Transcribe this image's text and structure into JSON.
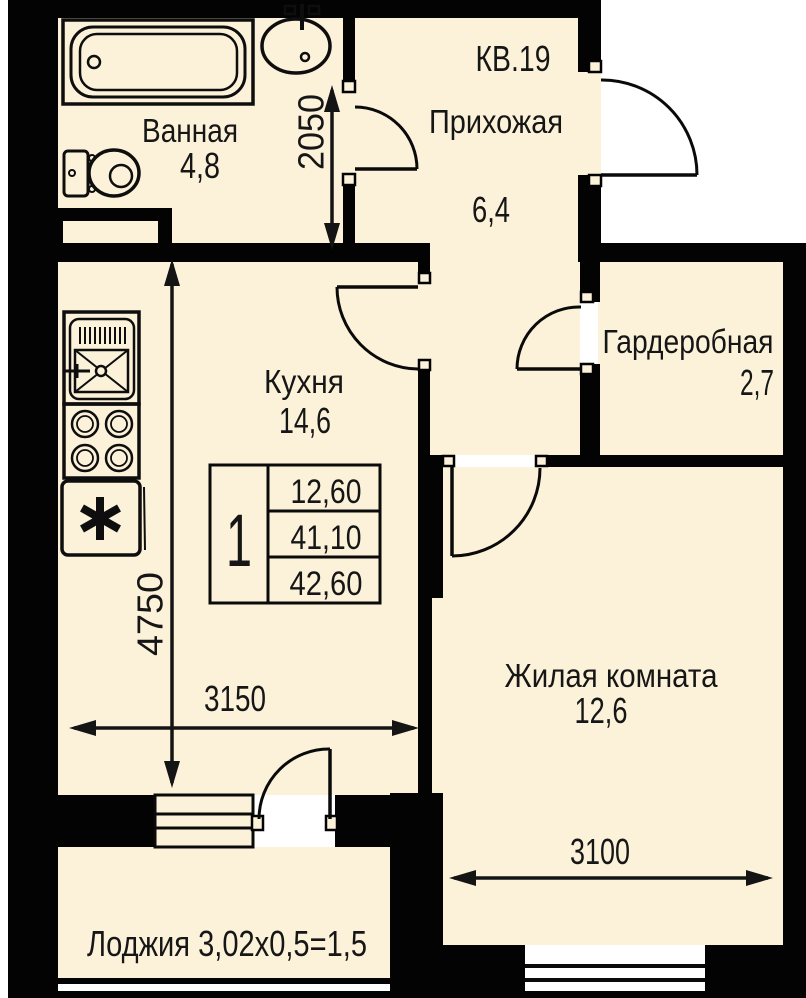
{
  "plan": {
    "apartment_label": "КВ.19",
    "rooms": [
      {
        "name": "Ванная",
        "area": "4,8"
      },
      {
        "name": "Прихожая",
        "area": "6,4"
      },
      {
        "name": "Кухня",
        "area": "14,6"
      },
      {
        "name": "Гардеробная",
        "area": "2,7"
      },
      {
        "name": "Жилая комната",
        "area": "12,6"
      }
    ],
    "loggia_label": "Лоджия 3,02x0,5=1,5",
    "dimensions": {
      "bathroom_width_mm": "2050",
      "kitchen_depth_mm": "4750",
      "kitchen_width_mm": "3150",
      "living_width_mm": "3100"
    },
    "info_table": {
      "unit_number": "1",
      "rows": [
        "12,60",
        "41,10",
        "42,60"
      ]
    },
    "colors": {
      "floor": "#fcf2da",
      "wall": "#030303",
      "text": "#161616"
    }
  }
}
